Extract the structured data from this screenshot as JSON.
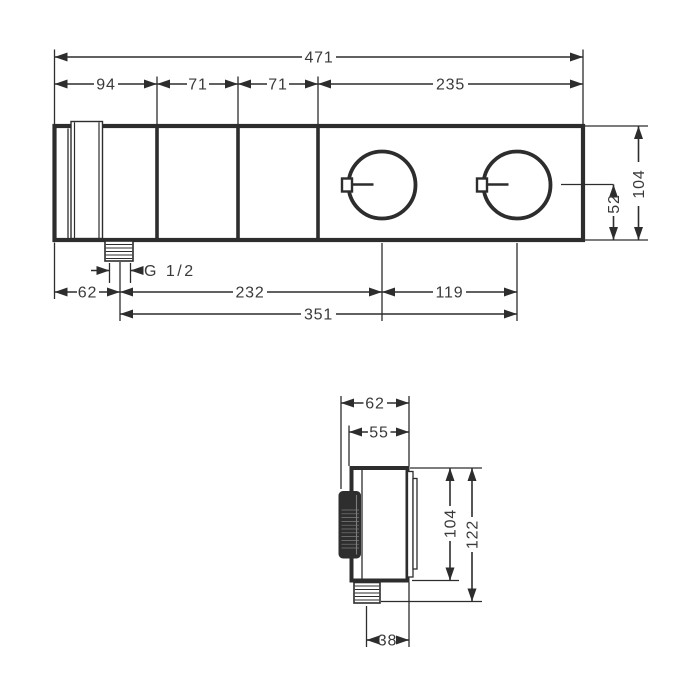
{
  "drawing": "thermostat-module-dimension-drawing",
  "colors": {
    "line": "#2d2d2d",
    "text": "#3a3a3a",
    "knob": "#2e2e2e",
    "background": "#ffffff"
  },
  "front_view": {
    "overall_width": "471",
    "segment_left": "94",
    "segment_mid1": "71",
    "segment_mid2": "71",
    "segment_right": "235",
    "body_height": "104",
    "knob_axis_to_bottom": "52",
    "left_to_outlet": "62",
    "outlet_thread": "G 1/2",
    "outlet_to_knob1": "232",
    "knob1_to_knob2": "119",
    "outlet_to_knob2": "351"
  },
  "side_view": {
    "depth_overall": "62",
    "depth_body": "55",
    "body_height": "104",
    "overall_height": "122",
    "outlet_center_to_wall": "38"
  }
}
